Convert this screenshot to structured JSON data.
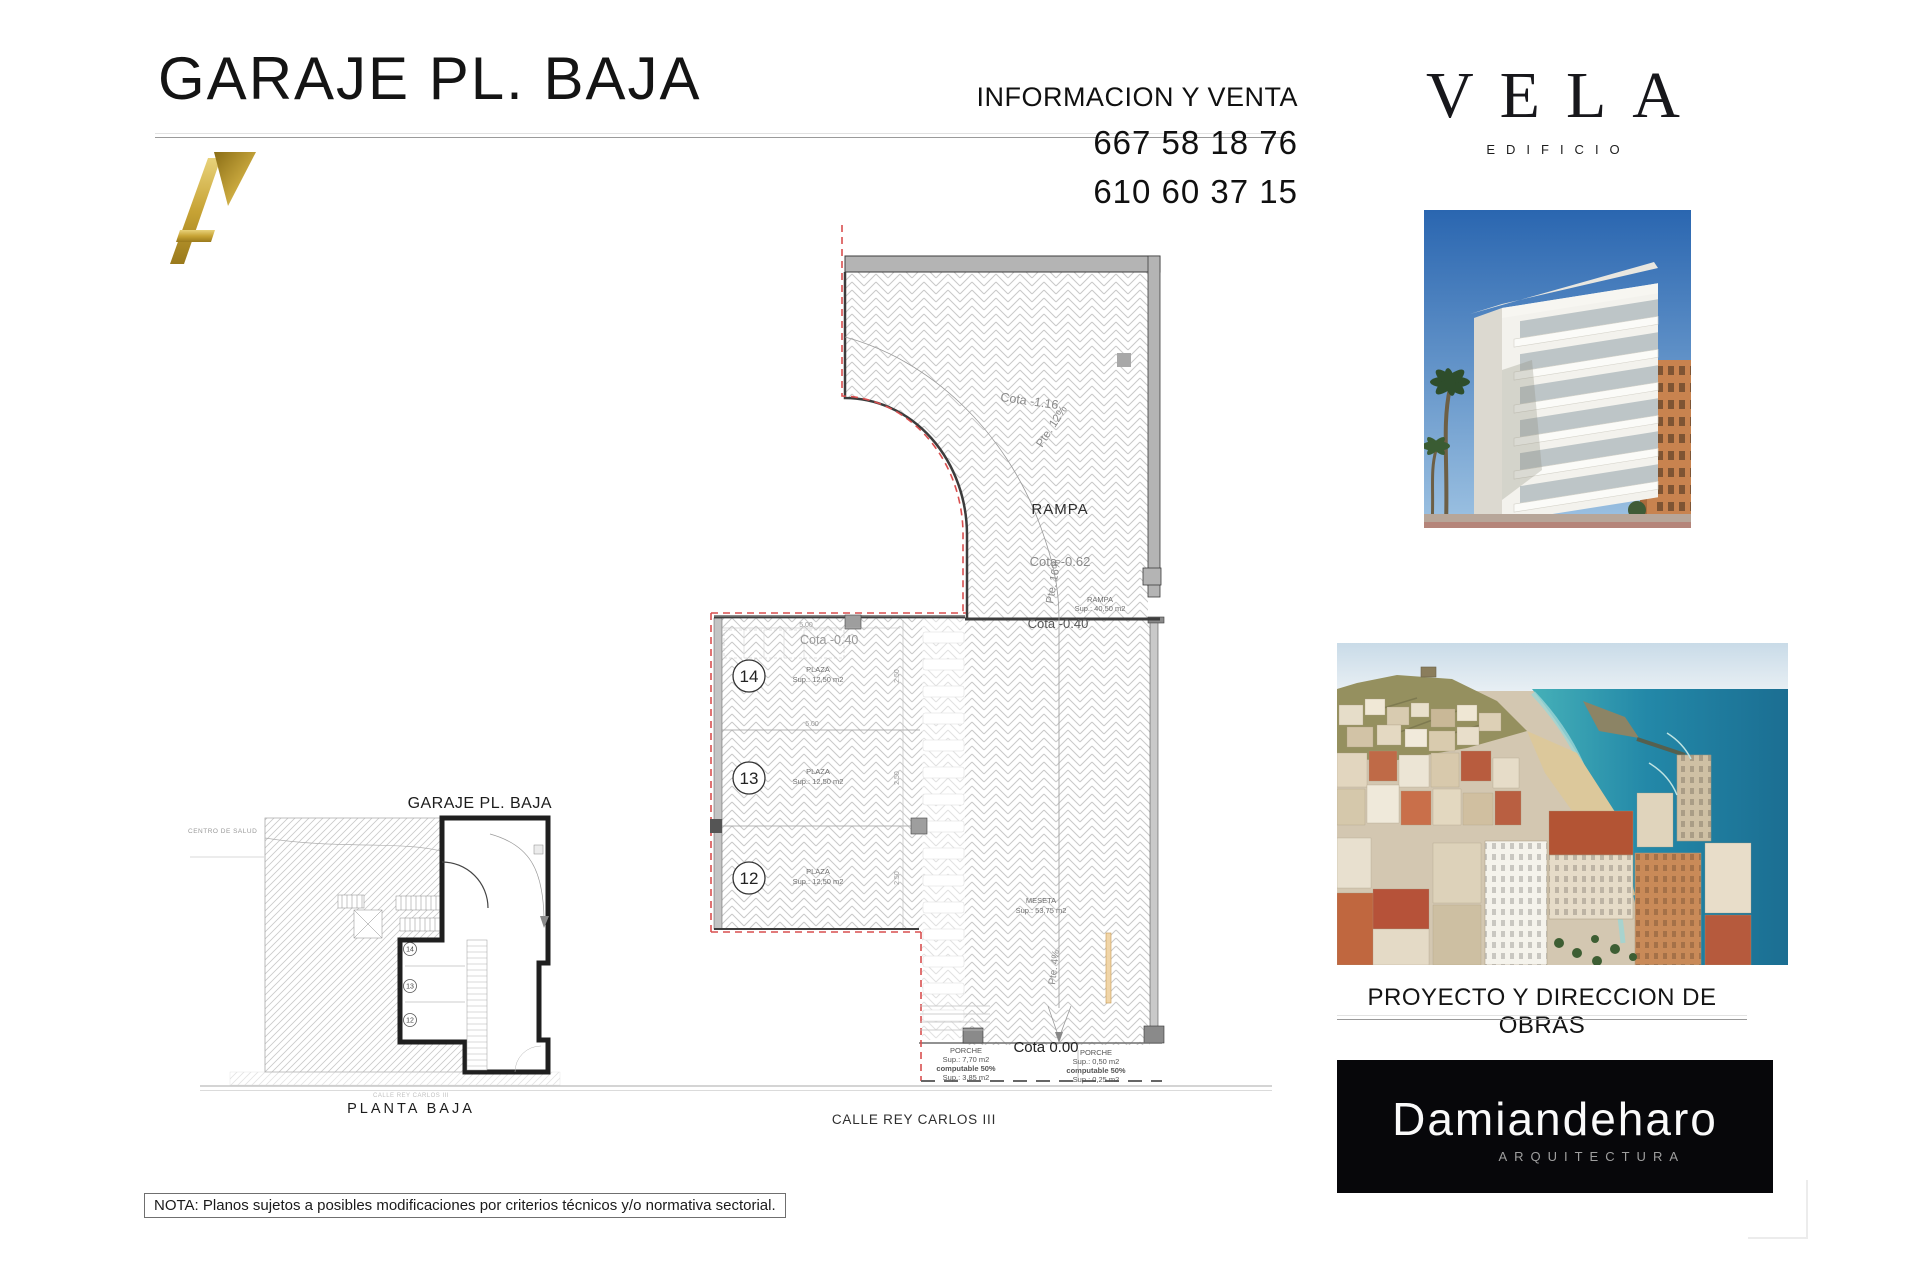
{
  "page": {
    "title": "GARAJE PL. BAJA",
    "note": "NOTA: Planos sujetos a posibles modificaciones por criterios técnicos y/o normativa sectorial."
  },
  "contact": {
    "heading": "INFORMACION Y VENTA",
    "phone1": "667 58 18 76",
    "phone2": "610 60 37 15"
  },
  "brand": {
    "name": "VELA",
    "subtitle": "EDIFICIO",
    "monogram": "A",
    "gold": "#c9a435"
  },
  "architect": {
    "heading": "PROYECTO Y DIRECCION DE OBRAS",
    "name": "Damiandeharo",
    "subtitle": "ARQUITECTURA",
    "box_color": "#07070a"
  },
  "main_plan": {
    "ramp_label": "RAMPA",
    "cota_upper": "Cota -1.16",
    "slope_upper": "Pte. 12%",
    "cota_mid": "Cota -0.62",
    "slope_mid": "Pte. 16%",
    "ramp_area_label": "RAMPA",
    "ramp_area_sup": "Sup.: 40,50 m2",
    "cota_entry": "Cota -0.40",
    "cota_top_left": "Cota -0.40",
    "meseta_label": "MESETA",
    "meseta_sup": "Sup.: 53,75 m2",
    "slope_lower": "Pte. 4%",
    "cota_zero": "Cota 0.00",
    "dims": {
      "width": "5.00",
      "depth": "2.50"
    },
    "spaces": [
      {
        "num": "14",
        "label": "PLAZA",
        "sup": "Sup.: 12,50 m2"
      },
      {
        "num": "13",
        "label": "PLAZA",
        "sup": "Sup.: 12,50 m2"
      },
      {
        "num": "12",
        "label": "PLAZA",
        "sup": "Sup.: 12,50 m2"
      }
    ],
    "porche_left": {
      "label": "PORCHE",
      "sup": "Sup.: 7,70 m2",
      "note": "computable 50%",
      "sup2": "Sup.: 3,85 m2"
    },
    "porche_right": {
      "label": "PORCHE",
      "sup": "Sup.: 0,50 m2",
      "note": "computable 50%",
      "sup2": "Sup.: 0,25 m2"
    },
    "street_label": "CALLE REY CARLOS III"
  },
  "overview_plan": {
    "title": "GARAJE PL. BAJA",
    "caption": "PLANTA  BAJA",
    "left_label": "CENTRO DE SALUD",
    "street_label": "CALLE REY CARLOS III",
    "spaces": [
      "14",
      "13",
      "12"
    ]
  }
}
